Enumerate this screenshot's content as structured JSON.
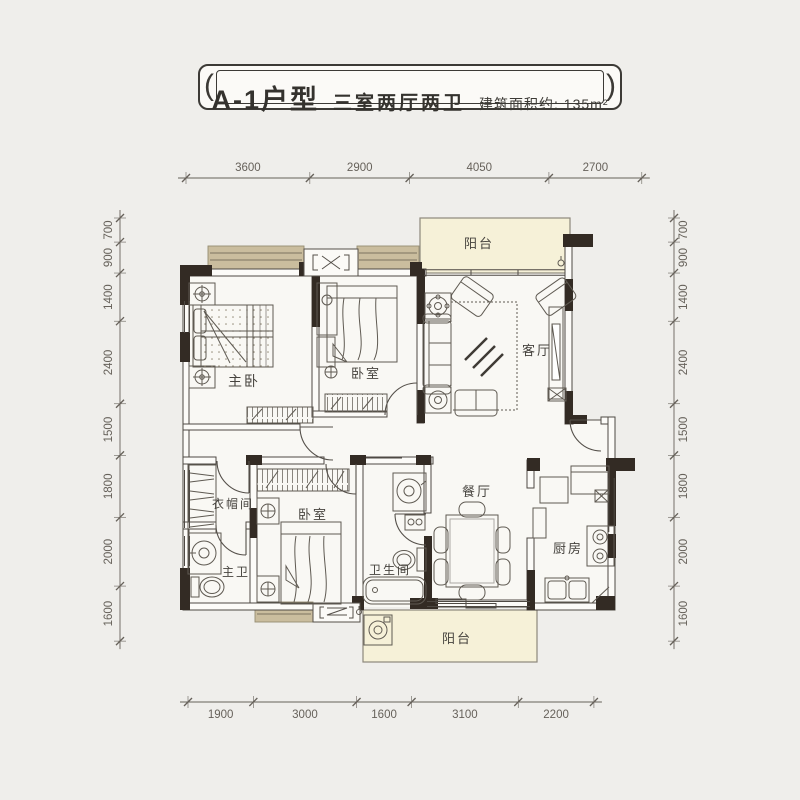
{
  "title_banner": {
    "ornament_left": "(",
    "unit": "A-1户型",
    "layout": "三室两厅两卫",
    "area": "建筑面积约: 135m²",
    "ornament_right": ")"
  },
  "colors": {
    "bg": "#efeeeb",
    "floor": "#f9f8f4",
    "wall": "#332b24",
    "line": "#55504a",
    "furn": "#5f5a52",
    "tan": "#cabd9e",
    "cream": "#f6f1d8",
    "dim": "#66615a",
    "label": "#46433e"
  },
  "rooms": [
    {
      "id": "master-bedroom",
      "label": "主卧",
      "x": 244,
      "y": 386,
      "size": 14
    },
    {
      "id": "bedroom-2",
      "label": "卧室",
      "x": 366,
      "y": 378,
      "size": 13
    },
    {
      "id": "living-room",
      "label": "客厅",
      "x": 537,
      "y": 355,
      "size": 13
    },
    {
      "id": "balcony-top",
      "label": "阳台",
      "x": 479,
      "y": 248,
      "size": 13
    },
    {
      "id": "cloakroom",
      "label": "衣帽间",
      "x": 233,
      "y": 508,
      "size": 12
    },
    {
      "id": "master-bath",
      "label": "主卫",
      "x": 236,
      "y": 576,
      "size": 12
    },
    {
      "id": "bedroom-3",
      "label": "卧室",
      "x": 313,
      "y": 519,
      "size": 13
    },
    {
      "id": "bathroom",
      "label": "卫生间",
      "x": 390,
      "y": 574,
      "size": 12
    },
    {
      "id": "dining-room",
      "label": "餐厅",
      "x": 477,
      "y": 496,
      "size": 13
    },
    {
      "id": "kitchen",
      "label": "厨房",
      "x": 568,
      "y": 553,
      "size": 13
    },
    {
      "id": "balcony-bottom",
      "label": "阳台",
      "x": 457,
      "y": 643,
      "size": 13
    }
  ],
  "dimensions": {
    "scale_px_per_mm": 0.0344,
    "top": {
      "values": [
        3600,
        2900,
        4050,
        2700
      ],
      "start_x": 186,
      "y": 178
    },
    "bottom": {
      "values": [
        1900,
        3000,
        1600,
        3100,
        2200
      ],
      "start_x": 188,
      "y": 702
    },
    "left": {
      "values": [
        700,
        900,
        1400,
        2400,
        1500,
        1800,
        2000,
        1600
      ],
      "start_y": 218,
      "x": 120
    },
    "right": {
      "values": [
        700,
        900,
        1400,
        2400,
        1500,
        1800,
        2000,
        1600
      ],
      "start_y": 218,
      "x": 674
    }
  }
}
